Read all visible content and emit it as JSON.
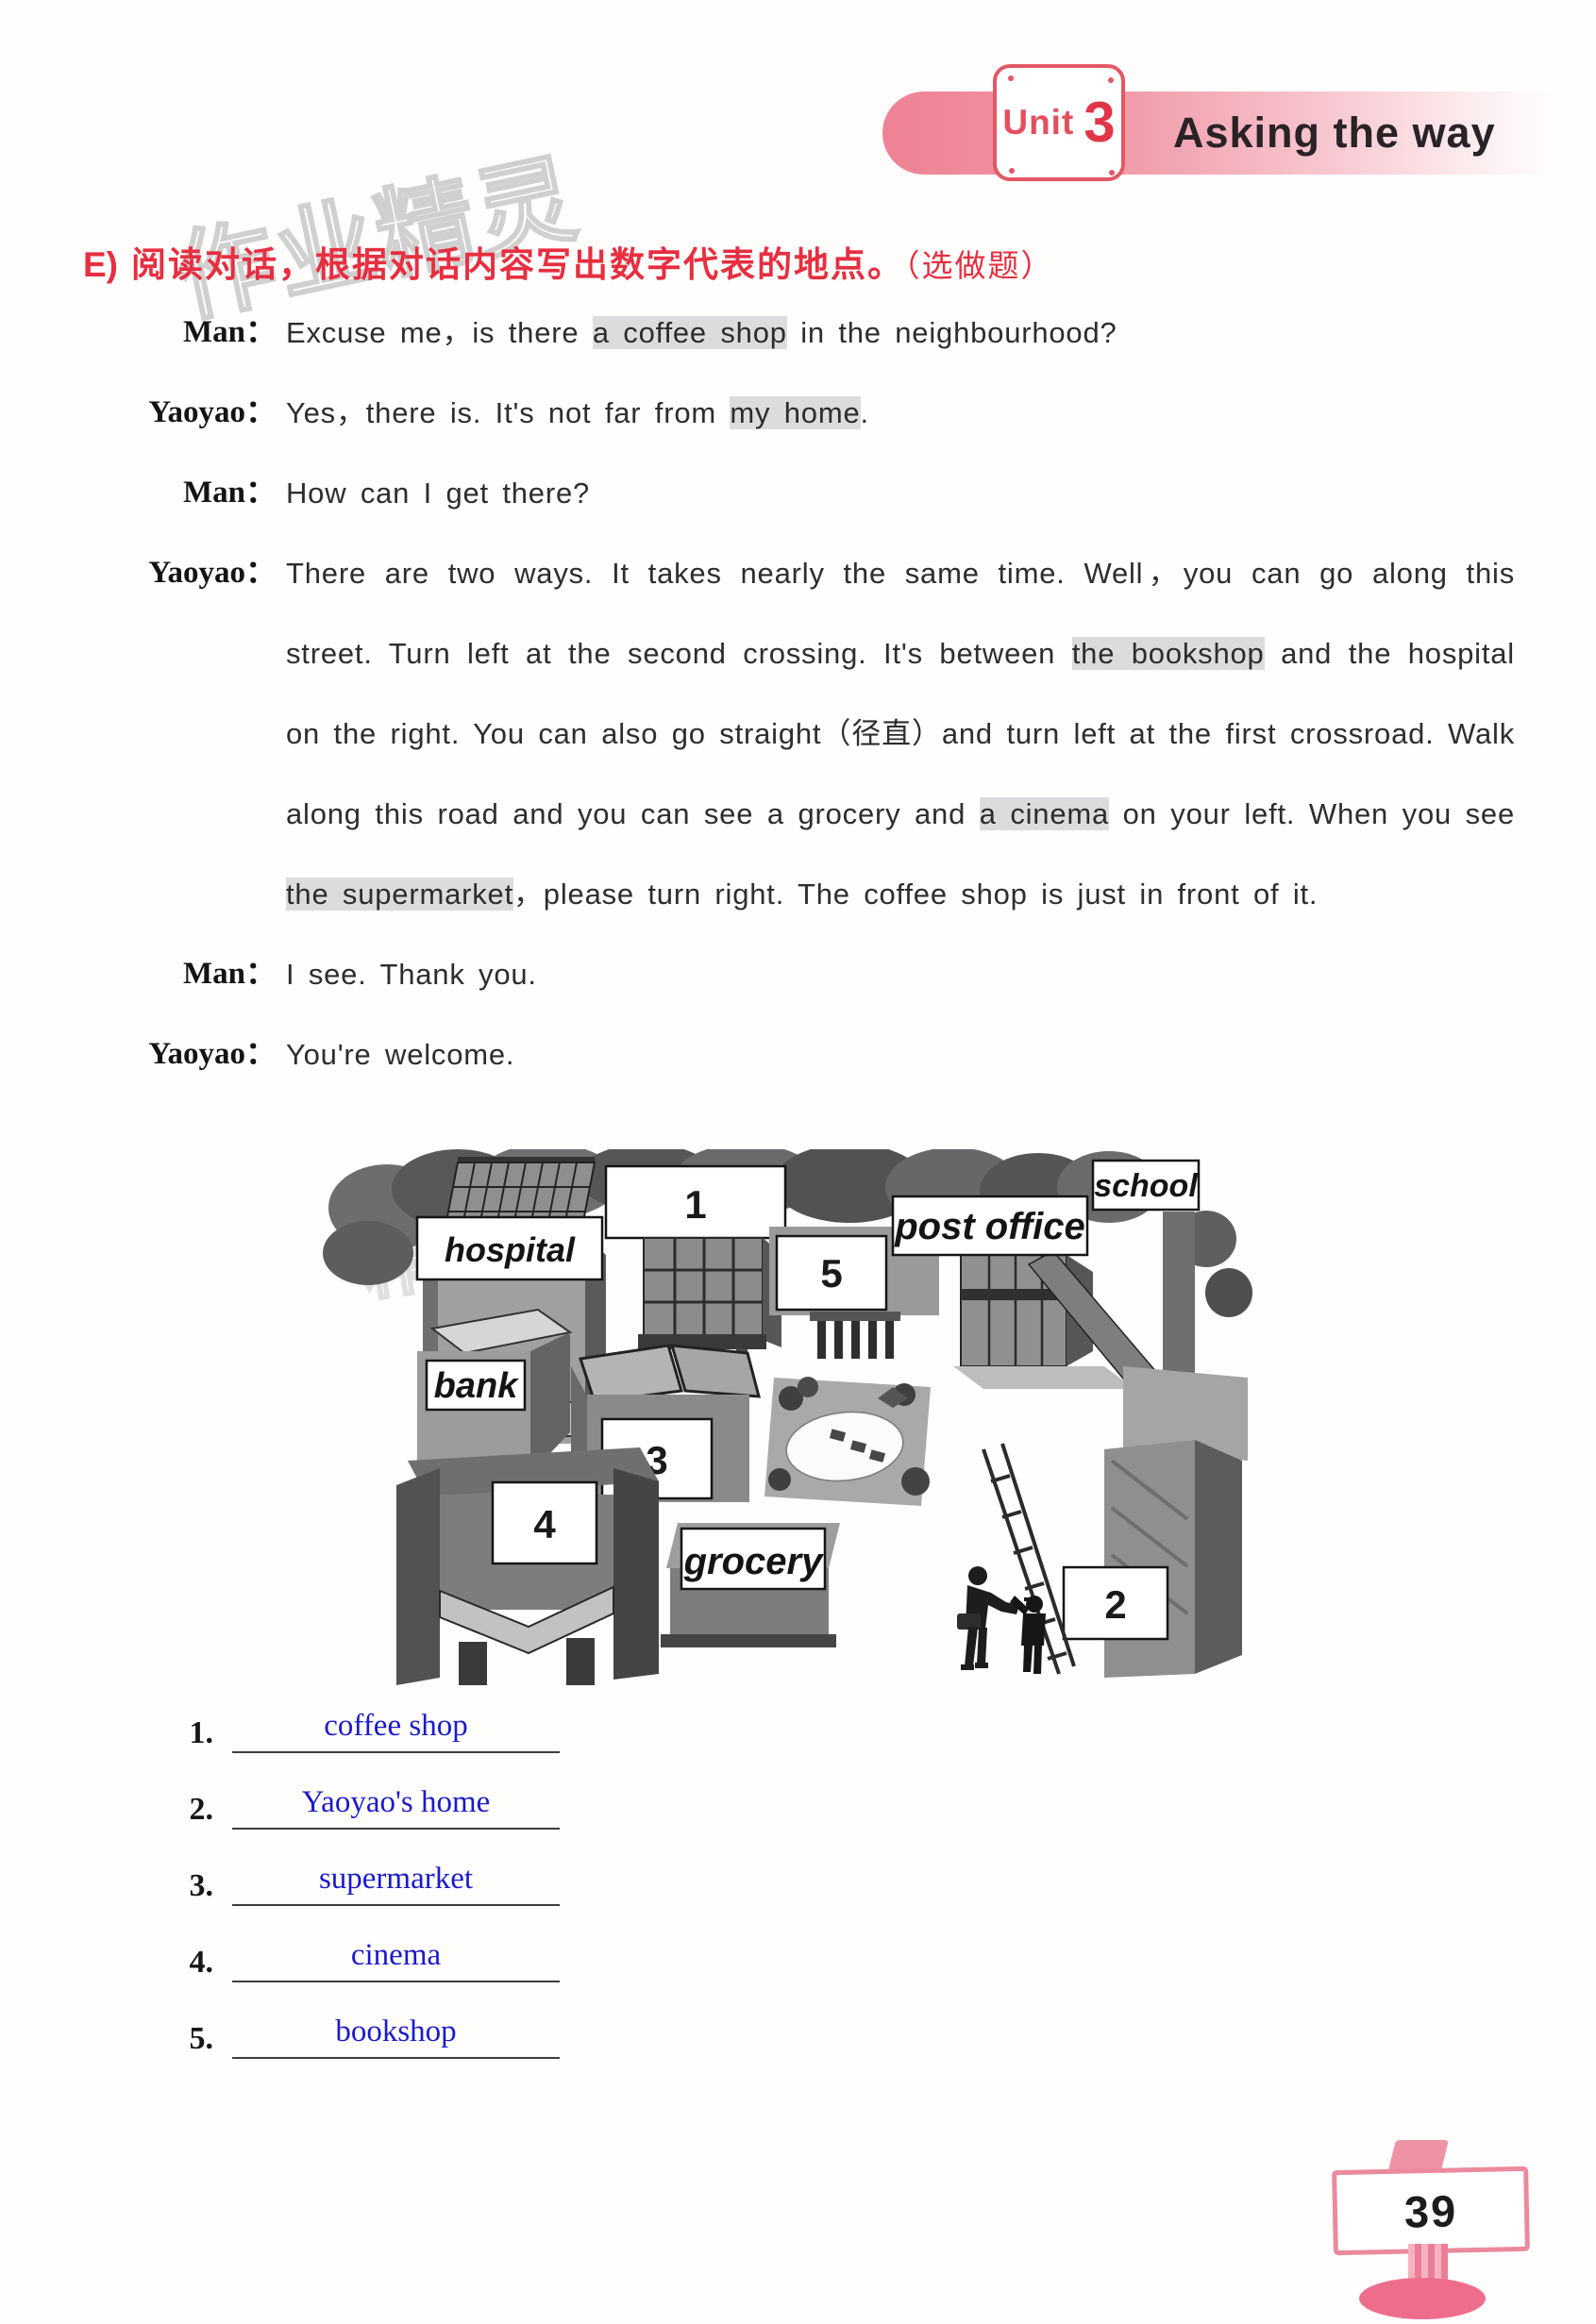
{
  "page": {
    "number": "39"
  },
  "header": {
    "unit_label": "Unit",
    "unit_number": "3",
    "title": "Asking the way"
  },
  "watermarks": {
    "top": "作业精灵",
    "map": "精灵"
  },
  "section": {
    "label": "E)",
    "instruction": "阅读对话，根据对话内容写出数字代表的地点。",
    "note": "（选做题）"
  },
  "dialogue": {
    "turns": [
      {
        "speaker": "Man：",
        "segments": [
          {
            "text": "Excuse me，is there "
          },
          {
            "text": "a coffee shop",
            "highlight": true
          },
          {
            "text": " in the neighbourhood?"
          }
        ]
      },
      {
        "speaker": "Yaoyao：",
        "segments": [
          {
            "text": "Yes，there is. It's not far from "
          },
          {
            "text": "my home",
            "highlight": true
          },
          {
            "text": "."
          }
        ]
      },
      {
        "speaker": "Man：",
        "segments": [
          {
            "text": "How can I get there?"
          }
        ]
      },
      {
        "speaker": "Yaoyao：",
        "segments": [
          {
            "text": "There are two ways. It takes nearly the same time. Well，you can go along this street. Turn left at the second crossing. It's between "
          },
          {
            "text": "the bookshop",
            "highlight": true
          },
          {
            "text": " and the hospital on the right. You can also go straight（径直）and turn left at the first crossroad. Walk along this road and you can see a grocery and "
          },
          {
            "text": "a cinema",
            "highlight": true
          },
          {
            "text": " on your left. When you see "
          },
          {
            "text": "the supermarket",
            "highlight": true
          },
          {
            "text": "，please turn right. The coffee shop is just in front of it."
          }
        ]
      },
      {
        "speaker": "Man：",
        "segments": [
          {
            "text": "I see. Thank you."
          }
        ]
      },
      {
        "speaker": "Yaoyao：",
        "segments": [
          {
            "text": "You're welcome."
          }
        ]
      }
    ]
  },
  "map": {
    "signs": {
      "hospital": "hospital",
      "bank": "bank",
      "school": "school",
      "post_office": "post office",
      "grocery": "grocery"
    },
    "numbers": {
      "n1": "1",
      "n2": "2",
      "n3": "3",
      "n4": "4",
      "n5": "5"
    }
  },
  "answers": {
    "items": [
      {
        "num": "1.",
        "answer": "coffee shop"
      },
      {
        "num": "2.",
        "answer": "Yaoyao's home"
      },
      {
        "num": "3.",
        "answer": "supermarket"
      },
      {
        "num": "4.",
        "answer": "cinema"
      },
      {
        "num": "5.",
        "answer": "bookshop"
      }
    ]
  },
  "colors": {
    "accent_red": "#e62f40",
    "band_pink": "#ee8294",
    "answer_blue": "#1a1acc",
    "highlight_gray": "#dcdcdc"
  }
}
